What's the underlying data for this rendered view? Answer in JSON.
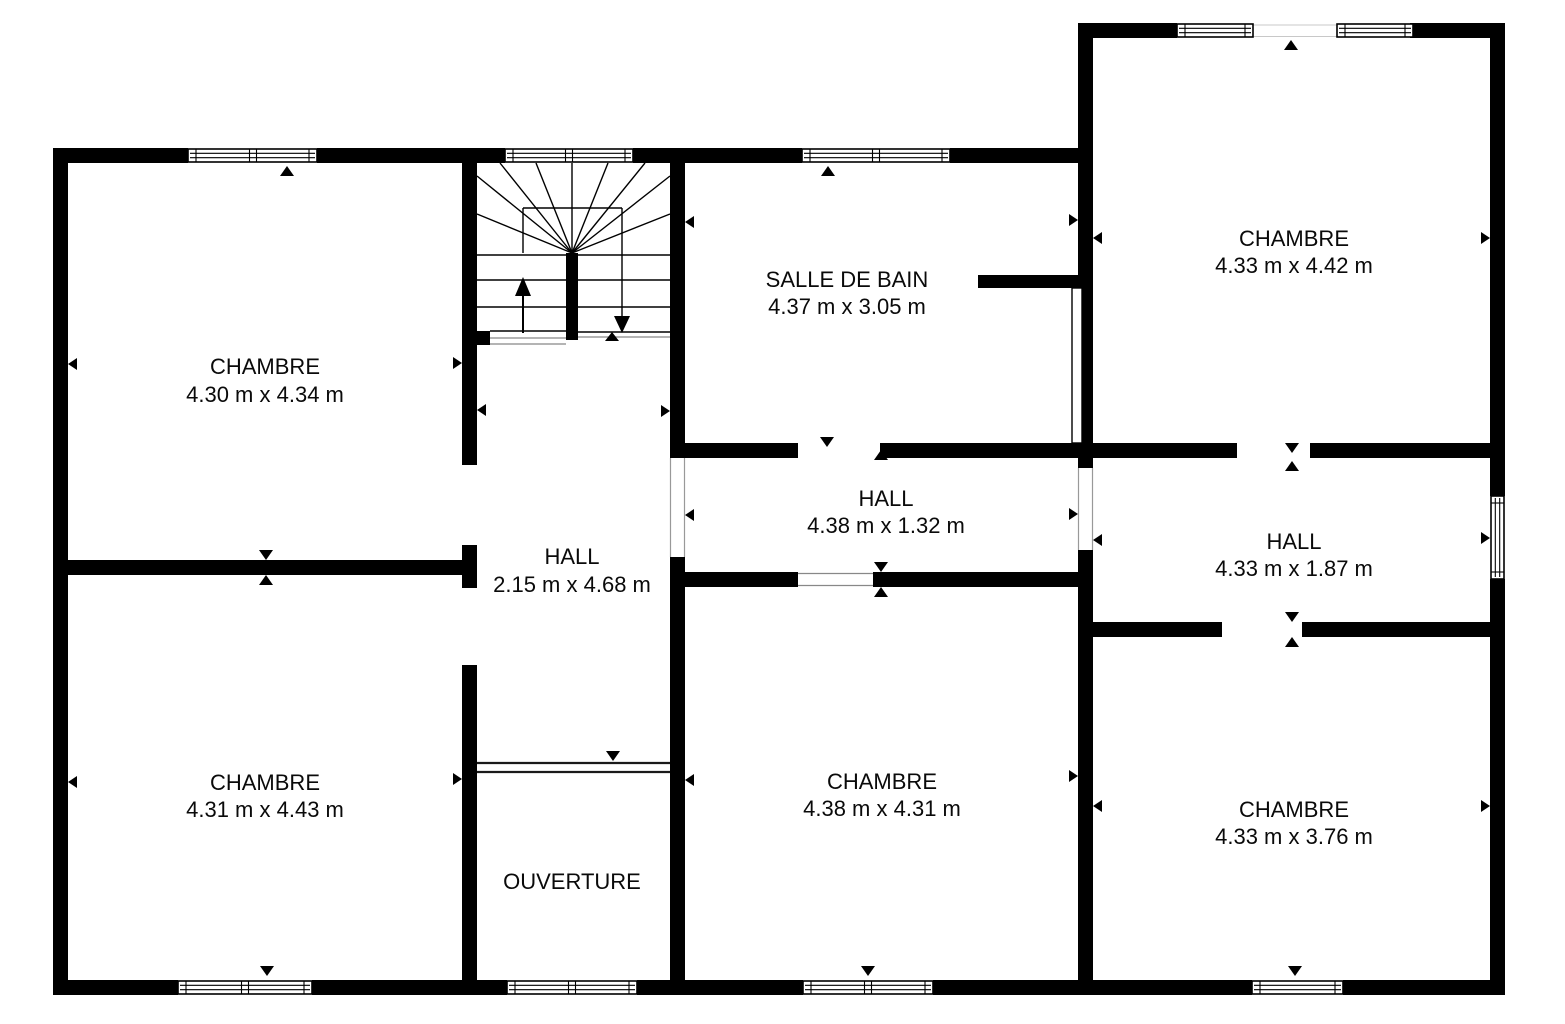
{
  "colors": {
    "wall": "#000000",
    "background": "#ffffff",
    "text": "#0a0a0a"
  },
  "rooms": [
    {
      "id": "chambre-top-left",
      "name": "CHAMBRE",
      "dims": "4.30 m x 4.34 m"
    },
    {
      "id": "chambre-bottom-left",
      "name": "CHAMBRE",
      "dims": "4.31 m x 4.43 m"
    },
    {
      "id": "hall-central",
      "name": "HALL",
      "dims": "2.15 m x 4.68 m"
    },
    {
      "id": "ouverture",
      "name": "OUVERTURE"
    },
    {
      "id": "salle-de-bain",
      "name": "SALLE DE BAIN",
      "dims": "4.37 m x 3.05 m"
    },
    {
      "id": "hall-middle",
      "name": "HALL",
      "dims": "4.38 m x 1.32 m"
    },
    {
      "id": "chambre-bottom-middle",
      "name": "CHAMBRE",
      "dims": "4.38 m x 4.31 m"
    },
    {
      "id": "chambre-top-right",
      "name": "CHAMBRE",
      "dims": "4.33 m x 4.42 m"
    },
    {
      "id": "hall-right",
      "name": "HALL",
      "dims": "4.33 m x 1.87 m"
    },
    {
      "id": "chambre-bottom-right",
      "name": "CHAMBRE",
      "dims": "4.33 m x 3.76 m"
    }
  ]
}
